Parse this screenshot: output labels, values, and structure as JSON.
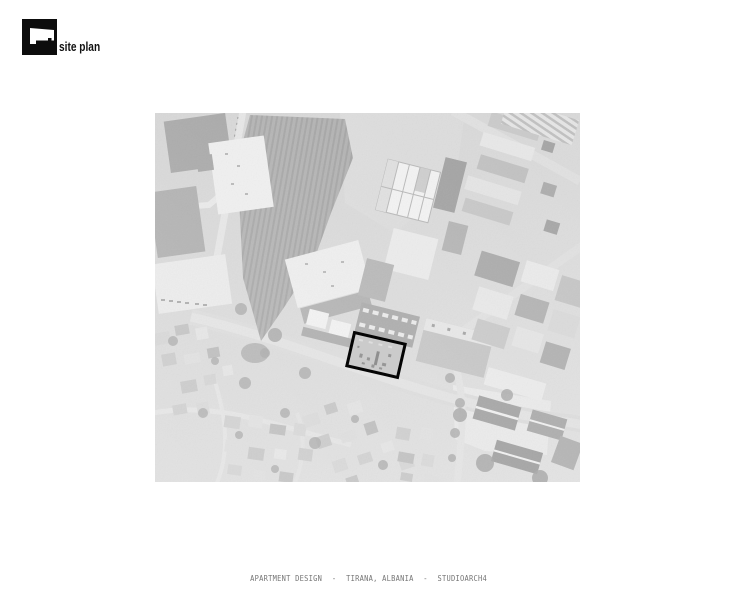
{
  "header": {
    "logo_label": "site plan",
    "logo_icon": "building-footprint-icon",
    "logo_color": "#0d0d0d"
  },
  "map": {
    "label": "aerial-site-photo",
    "site_outline_color": "#000000",
    "base_color": "#d4d4d4"
  },
  "footer": {
    "project": "APARTMENT DESIGN",
    "separator": "-",
    "location": "TIRANA, ALBANIA",
    "studio": "STUDIOARCH4"
  }
}
